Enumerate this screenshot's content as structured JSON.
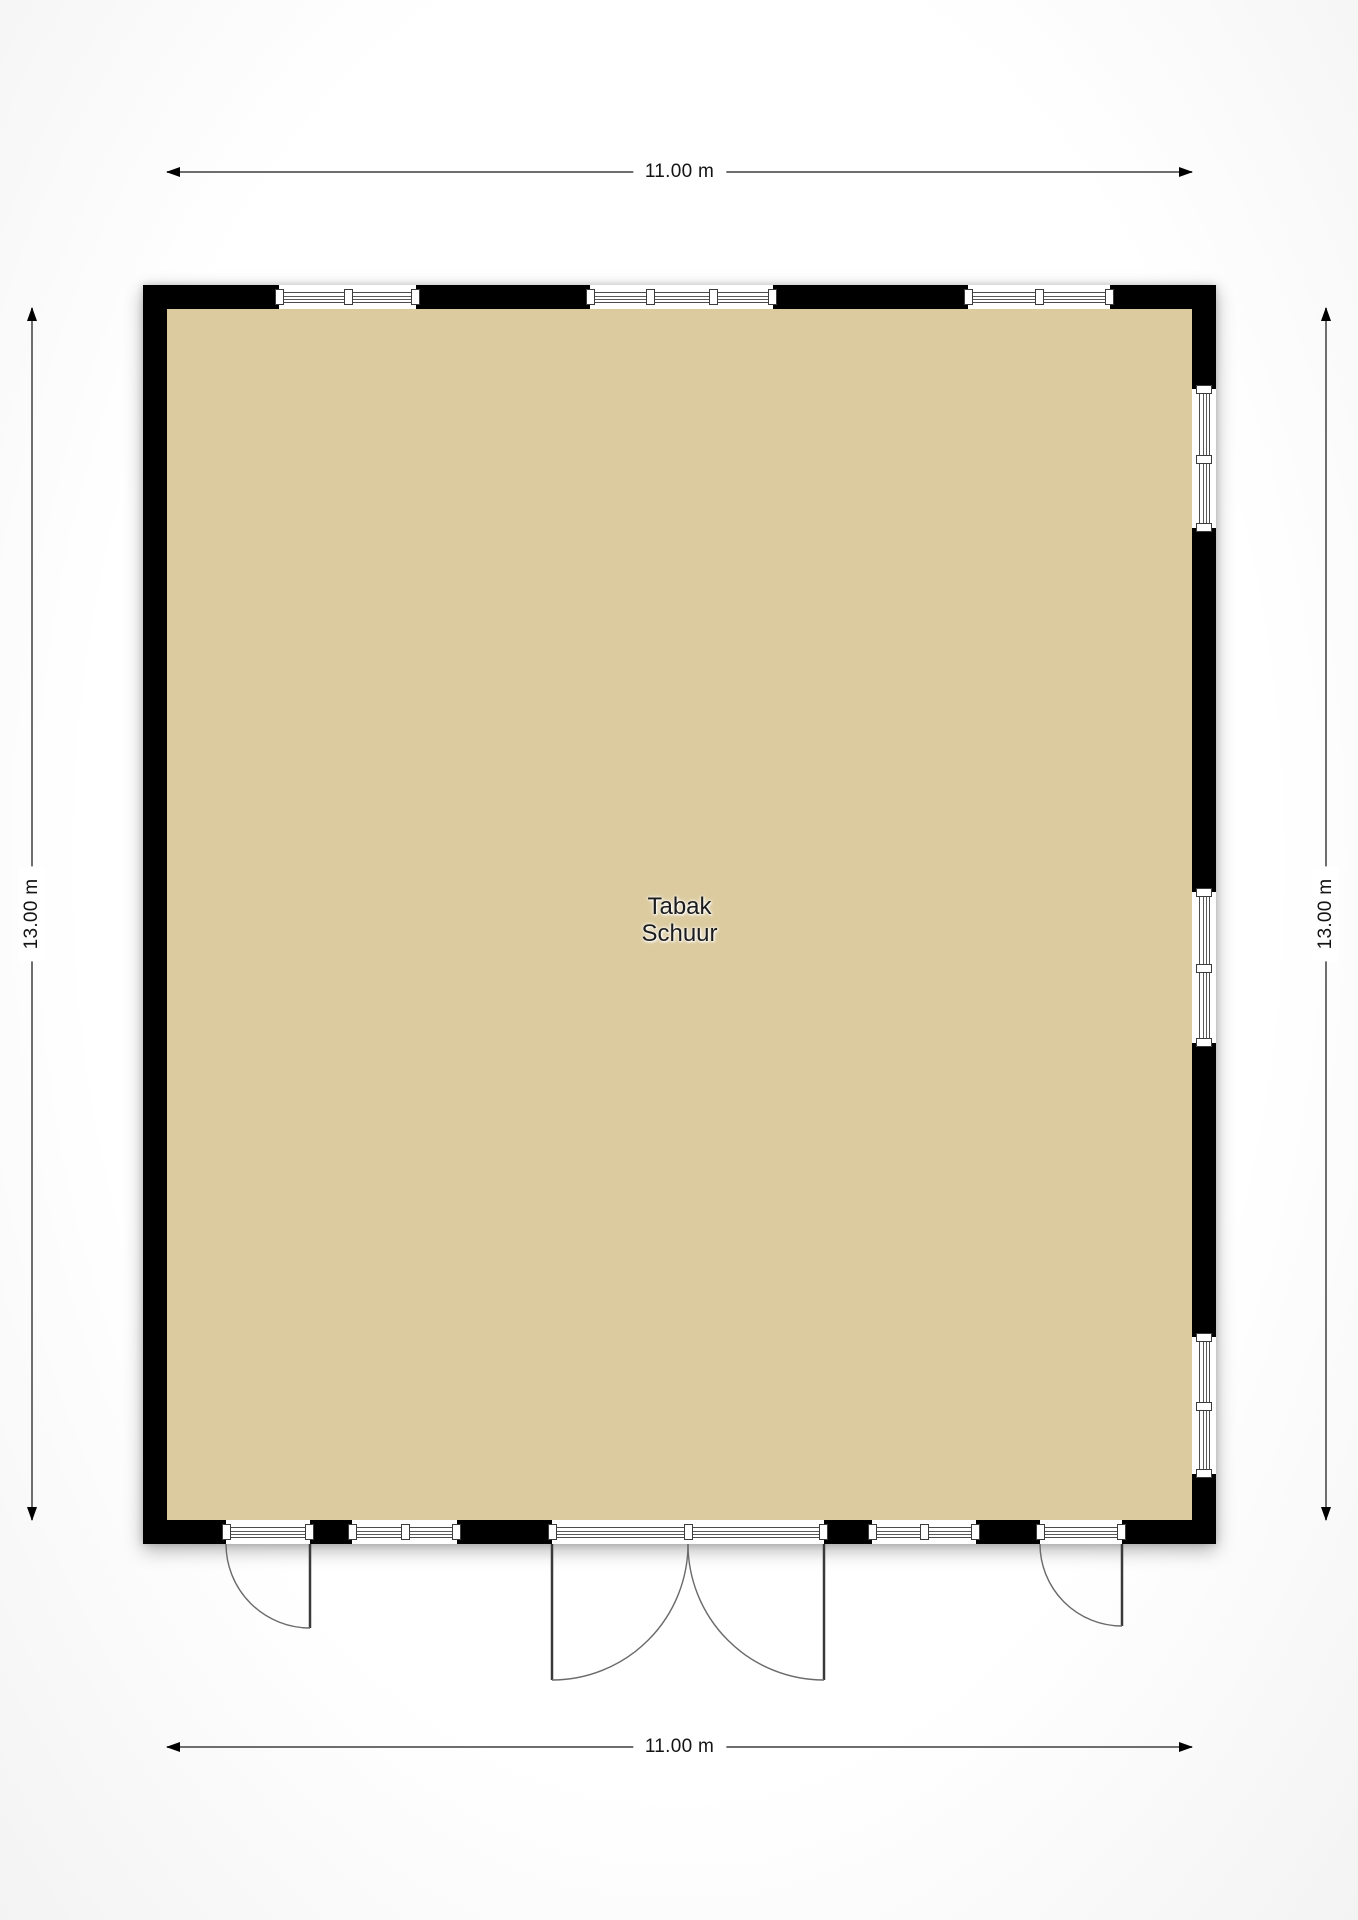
{
  "plan": {
    "room": {
      "label_line1": "Tabak",
      "label_line2": "Schuur"
    },
    "dimensions": {
      "top": "11.00 m",
      "bottom": "11.00 m",
      "left": "13.00 m",
      "right": "13.00 m"
    },
    "colors": {
      "floor": "#dccb9f",
      "wall": "#000000",
      "dimension_line": "#6e6e6e",
      "background": "#ffffff"
    }
  }
}
